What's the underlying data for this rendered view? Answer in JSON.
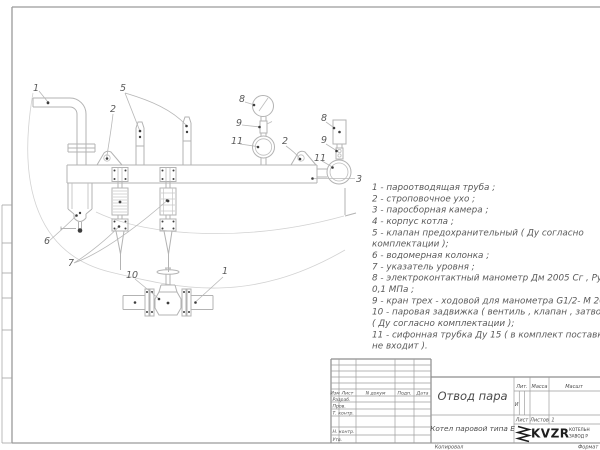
{
  "drawing": {
    "callouts": [
      "1",
      "5",
      "2",
      "8",
      "9",
      "11",
      "2",
      "8",
      "9",
      "11",
      "3",
      "6",
      "7",
      "10",
      "1"
    ]
  },
  "parts_list": {
    "lines": [
      "1 -  пароотводящая труба ;",
      "2 -  строповочное ухо ;",
      "3 -  паросборная камера ;",
      "4 -  корпус котла ;",
      "5 -  клапан предохранительный  ( Ду согласно",
      "комплектации );",
      "6 -  водомерная колонка ;",
      "7 - указатель уровня ;",
      "8 - электроконтактный манометр  Дм 2005 Сг ,  Ру",
      "0,1  МПа ;",
      "9 -  кран трех - ходовой для манометра  G1/2- М 20,",
      "10 -  паровая задвижка  ( вентиль ,  клапан ,  затвор",
      "( Ду согласно комплектации );",
      "11 -  сифонная трубка  Ду 15  ( в комплект поставки",
      "не входит )."
    ]
  },
  "title_block": {
    "revision_header": {
      "izm": "Изм",
      "list": "Лист",
      "n_dokum": "N докум",
      "podp": "Подп.",
      "data": "Дата"
    },
    "rows": {
      "razrab": "Разраб.",
      "prov": "Пров.",
      "t_kontr": "Т. контр.",
      "n_kontr": "Н. контр.",
      "utv": "Утв."
    },
    "title": "Отвод пара",
    "subtitle": "Котел паровой типа Е",
    "lit_label": "Лит.",
    "lit_value": "И",
    "massa_label": "Масса",
    "masshtab_label": "Масшт",
    "list_label": "Лист",
    "listov_label": "Листов",
    "listov_value": "1",
    "logo": {
      "name": "KVZR",
      "line1": "КОТЕЛЬН",
      "line2": "ЗАВОД Р"
    }
  },
  "footer": {
    "left": "Копировал",
    "right": "Формат"
  }
}
